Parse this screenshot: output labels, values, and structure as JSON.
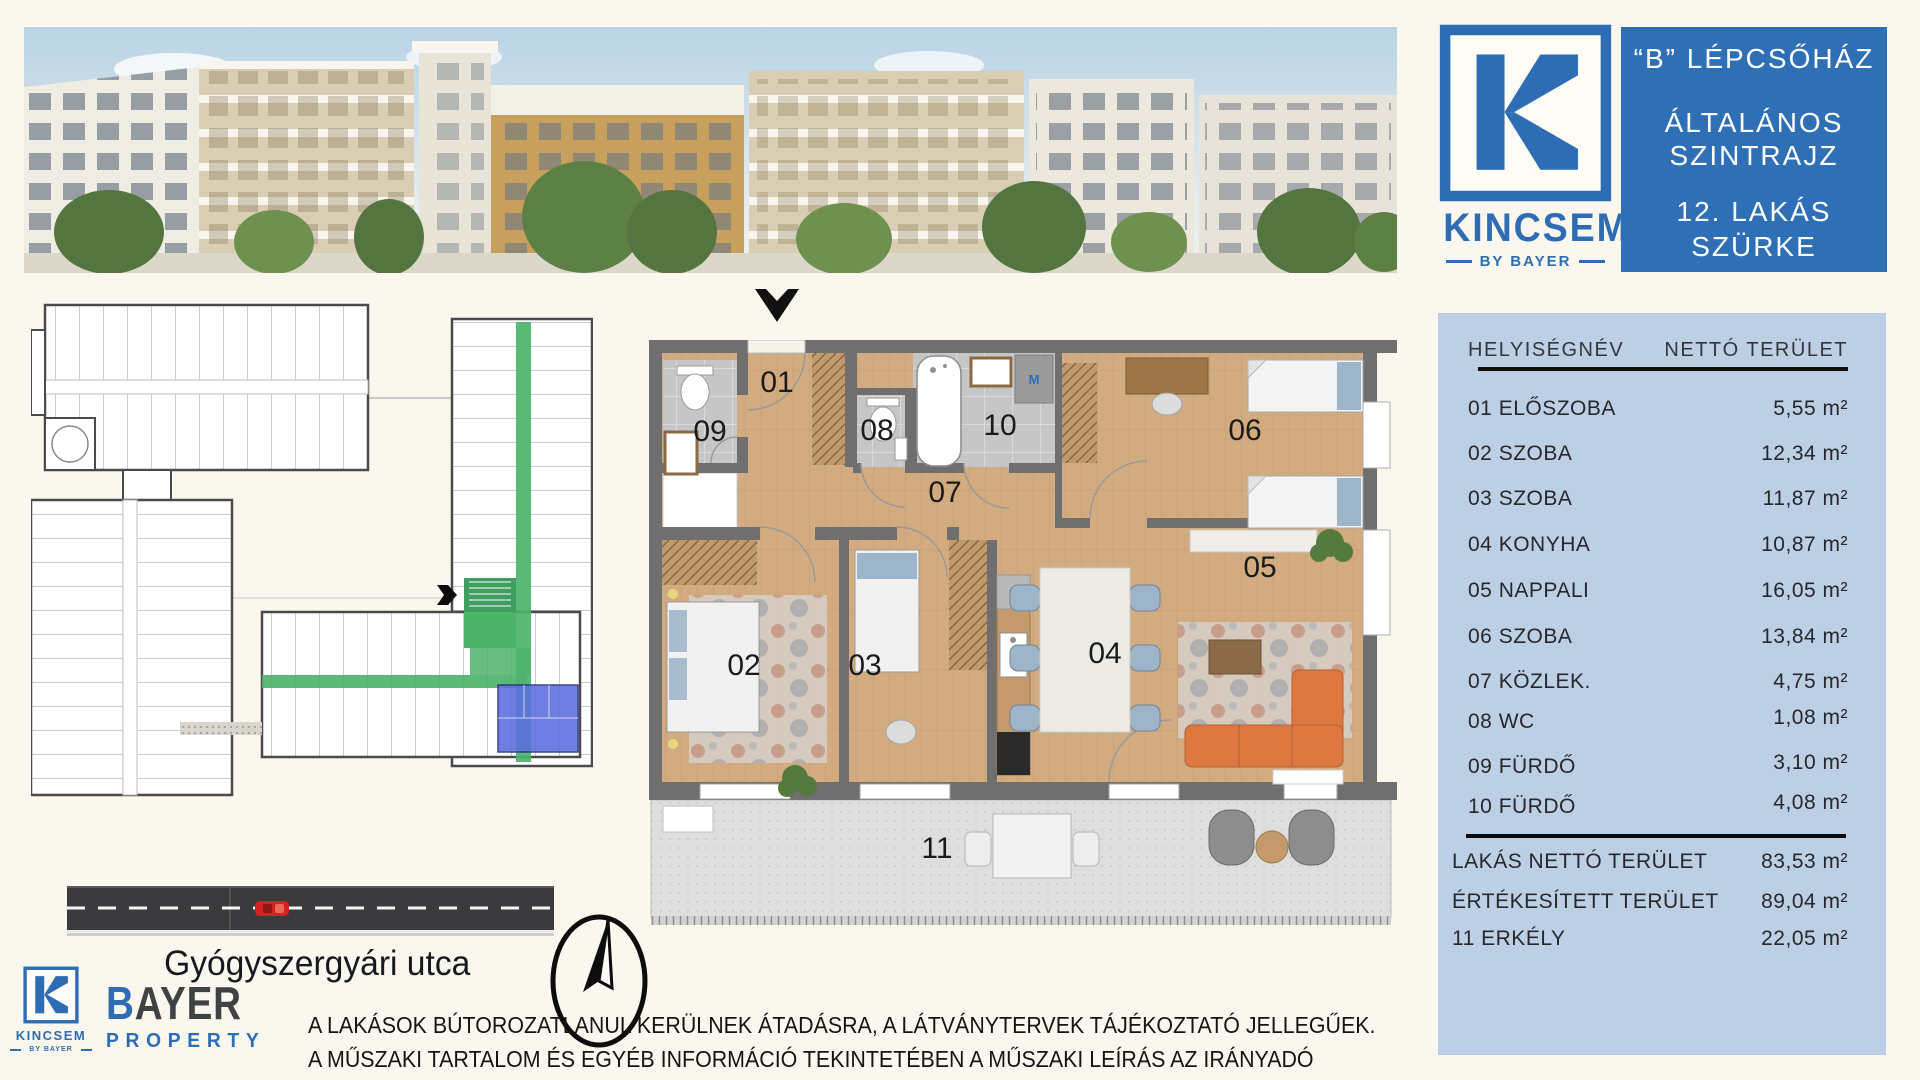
{
  "colors": {
    "brand_blue": "#2E6DB4",
    "panel_blue": "#2F6FB5",
    "table_bg": "#BCCFE5",
    "corridor_green": "#4DB36B",
    "unit_blue": "#5B6DE0",
    "wood": "#D2AB80",
    "wall_gray": "#6F6F6F",
    "sofa_orange": "#DD7840",
    "asphalt": "#3B3B3D",
    "background_cream": "#FAF7EE"
  },
  "logo": {
    "name": "KINCSEM",
    "byline": "BY BAYER"
  },
  "header_panel": {
    "line1": "“B” LÉPCSŐHÁZ",
    "line2": "ÁLTALÁNOS",
    "line3": "SZINTRAJZ",
    "line4": "12. LAKÁS",
    "line5": "SZÜRKE"
  },
  "table": {
    "header": {
      "name": "HELYISÉGNÉV",
      "area": "NETTÓ TERÜLET"
    },
    "rows": [
      {
        "label": "01 ELŐSZOBA",
        "area": "5,55 m²"
      },
      {
        "label": "02 SZOBA",
        "area": "12,34 m²"
      },
      {
        "label": "03 SZOBA",
        "area": "11,87 m²"
      },
      {
        "label": "04 KONYHA",
        "area": "10,87 m²"
      },
      {
        "label": "05 NAPPALI",
        "area": "16,05 m²"
      },
      {
        "label": "06 SZOBA",
        "area": "13,84 m²"
      },
      {
        "label": "07 KÖZLEK.",
        "area": "4,75 m²"
      },
      {
        "label": "08 WC",
        "area": "1,08 m²"
      },
      {
        "label": "09 FÜRDŐ",
        "area": "3,10 m²"
      },
      {
        "label": "10 FÜRDŐ",
        "area": "4,08 m²"
      }
    ],
    "summary": [
      {
        "label": "LAKÁS NETTÓ TERÜLET",
        "area": "83,53 m²"
      },
      {
        "label": "ÉRTÉKESÍTETT TERÜLET",
        "area": "89,04 m²"
      },
      {
        "label": "11 ERKÉLY",
        "area": "22,05 m²"
      }
    ]
  },
  "plan": {
    "labels": {
      "r01": "01",
      "r02": "02",
      "r03": "03",
      "r04": "04",
      "r05": "05",
      "r06": "06",
      "r07": "07",
      "r08": "08",
      "r09": "09",
      "r10": "10",
      "r11": "11"
    },
    "appliances": {
      "washer": "M",
      "fridge": "H",
      "dishwasher": "MG"
    }
  },
  "map": {
    "street": "Gyógyszergyári utca"
  },
  "footer": {
    "bayer_b": "B",
    "bayer_rest": "AYER",
    "property": "PROPERTY",
    "disclaimer1": "A LAKÁSOK BÚTOROZATLANUL KERÜLNEK ÁTADÁSRA, A LÁTVÁNYTERVEK TÁJÉKOZTATÓ JELLEGŰEK.",
    "disclaimer2": "A MŰSZAKI TARTALOM ÉS EGYÉB INFORMÁCIÓ TEKINTETÉBEN A MŰSZAKI LEÍRÁS AZ IRÁNYADÓ"
  }
}
